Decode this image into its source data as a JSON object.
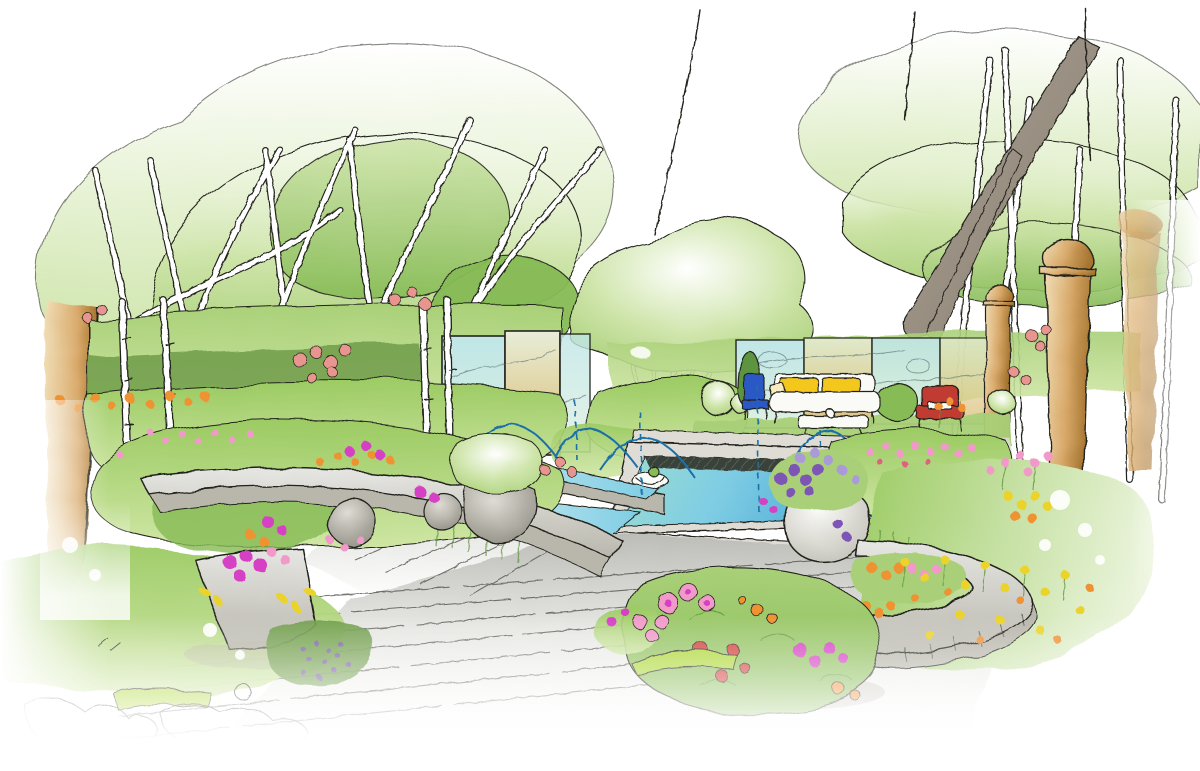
{
  "meta": {
    "title": "Hand-drawn garden design perspective sketch",
    "medium": "ink line with watercolor-marker washes",
    "width_px": 1200,
    "height_px": 771
  },
  "scene": {
    "description": "Perspective concept sketch of a contemporary garden: multi-stem birch trees left and right, mirrored screen panels along the back boundary, a sunken aqua pool with arcing water jets fed by a raised rill, a broad timber deck in the foreground, two sweeping curved stone benches with stone spheres and planted urns, lush flower borders in magenta, pink, orange and yellow, a wildflower meadow and tan stone columns on the right, and a seating terrace with a yellow sofa, red armchair and blue chair in front of the mirrors.",
    "elements": [
      {
        "name": "tree-canopies"
      },
      {
        "name": "multi-stem-birch-trunks"
      },
      {
        "name": "boundary-wall-left"
      },
      {
        "name": "back-hedge"
      },
      {
        "name": "mirror-screen-panels"
      },
      {
        "name": "seating-terrace"
      },
      {
        "name": "outdoor-sofa"
      },
      {
        "name": "red-armchair"
      },
      {
        "name": "blue-chair"
      },
      {
        "name": "coffee-table"
      },
      {
        "name": "topiary-balls"
      },
      {
        "name": "sunken-pool"
      },
      {
        "name": "raised-rill"
      },
      {
        "name": "water-jets"
      },
      {
        "name": "stone-steps"
      },
      {
        "name": "timber-deck"
      },
      {
        "name": "curved-stone-bench-left"
      },
      {
        "name": "curved-stone-bench-right"
      },
      {
        "name": "stone-spheres"
      },
      {
        "name": "planter-pots"
      },
      {
        "name": "flower-urn"
      },
      {
        "name": "flower-borders"
      },
      {
        "name": "wildflower-meadow"
      },
      {
        "name": "stone-columns"
      },
      {
        "name": "foreground-flower-bush"
      }
    ]
  },
  "palette": {
    "paper": "#ffffff",
    "ink": "#24241f",
    "foliage_pale": "#e9f3d9",
    "foliage_light": "#cfe5ab",
    "foliage_mid": "#a9d078",
    "foliage_deep": "#86bb55",
    "foliage_dark": "#5d9440",
    "hedge_dark": "#6f9c49",
    "shrub_bright": "#9ccb63",
    "grass_light": "#cfe6a4",
    "grass_bright": "#aed838",
    "water_light": "#c7eaf0",
    "water_mid": "#7fcde4",
    "water_deep": "#4aa9d4",
    "water_teal": "#9bdcd2",
    "jet_blue": "#1f6fa8",
    "pool_shadow": "#39423a",
    "deck_light": "#e6e6e3",
    "deck_mid": "#bcbcb7",
    "deck_dark": "#8f8f8a",
    "plank_line": "#55554f",
    "stone_light": "#dedcd4",
    "stone_mid": "#b9b7ac",
    "stone_dark": "#87857a",
    "tan_light": "#f0dcb4",
    "tan_mid": "#d8a96a",
    "tan_dark": "#a5742f",
    "trunk_gray": "#a8a49a",
    "branch_brown": "#8a7b6a",
    "mirror_aqua": "#bfe6e6",
    "mirror_green": "#dff0e2",
    "mirror_amber": "#d9b96a",
    "mirror_cream": "#e8edd8",
    "flower_magenta": "#d63fc4",
    "flower_pink": "#f19ac9",
    "flower_rose": "#e0607f",
    "flower_red": "#d5413a",
    "flower_orange": "#ef9233",
    "flower_yellow": "#ecd32b",
    "flower_purple": "#7d57b5",
    "flower_lavender": "#a99ad8",
    "rose_salmon": "#e8948f",
    "sofa_yellow": "#f3c71c",
    "cushion_cream": "#f7ecc0",
    "chair_red": "#c03a33",
    "chair_blue": "#2b59c4",
    "furniture_white": "#fafaf7",
    "shadow_warm": "#b9b2a6"
  }
}
